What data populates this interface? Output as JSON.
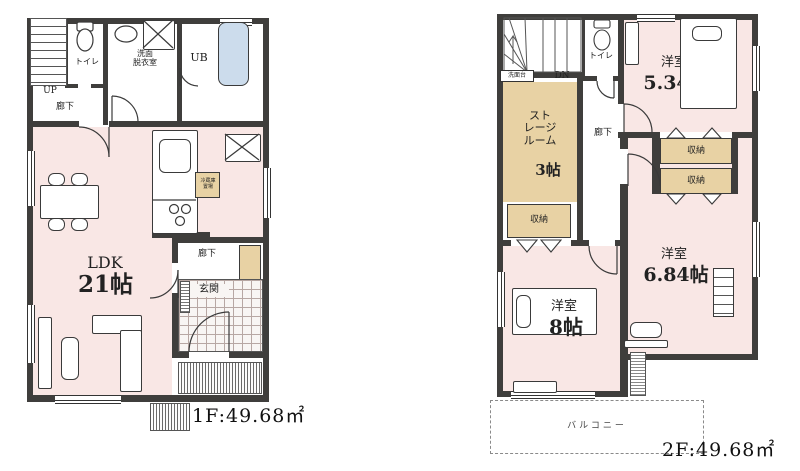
{
  "colors": {
    "wall": "#3f3e3c",
    "room_pink": "#f9e7e5",
    "closet_tan": "#e8d2a4",
    "bath_blue": "#ccdcec"
  },
  "floor1": {
    "area_label": "1F:49.68㎡",
    "labels": {
      "up": "UP",
      "toilet": "トイレ",
      "hall_upper": "廊下",
      "washroom": "洗面\n脱衣室",
      "bath": "UB",
      "fridge": "冷蔵庫\n置場",
      "ldk_name": "LDK",
      "ldk_size": "21帖",
      "hall_entry": "廊下",
      "entrance": "玄関"
    }
  },
  "floor2": {
    "area_label": "2F:49.68㎡",
    "labels": {
      "dn": "DN",
      "landing_fixture": "洗面台",
      "toilet": "トイレ",
      "storage_name": "スト\nレージ\nルーム",
      "storage_size": "3帖",
      "storage_closet": "収納",
      "hall": "廊下",
      "bedroom1_name": "洋室",
      "bedroom1_size": "5.34帖",
      "closet1": "収納",
      "closet2": "収納",
      "bedroom2_name": "洋室",
      "bedroom2_size": "6.84帖",
      "bedroom3_name": "洋室",
      "bedroom3_size": "8帖",
      "balcony": "バルコニー"
    }
  }
}
